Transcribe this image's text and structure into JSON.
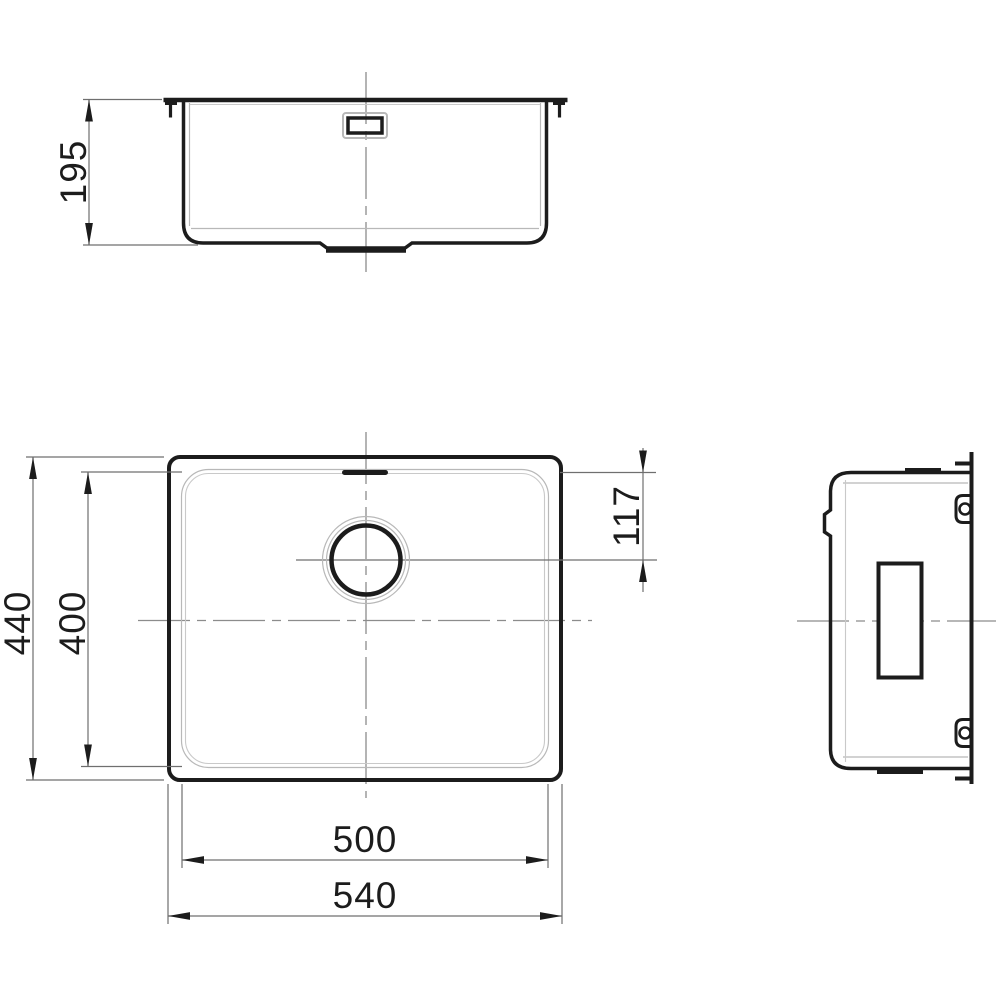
{
  "drawing": {
    "background": "#ffffff",
    "outline_color": "#1c1c1c",
    "thin_line_color": "#b8b8b8",
    "dim_line_color": "#6f6f6f",
    "centerline_color": "#8c8c8c",
    "text_color": "#1c1c1c",
    "views": {
      "front_elevation": {
        "dims": {
          "depth": "195"
        }
      },
      "plan": {
        "dims": {
          "overall_width": "440",
          "bowl_width": "400",
          "drain_center_offset": "117",
          "bowl_length": "500",
          "overall_length": "540"
        }
      },
      "side_elevation": {
        "dims": {}
      }
    }
  }
}
